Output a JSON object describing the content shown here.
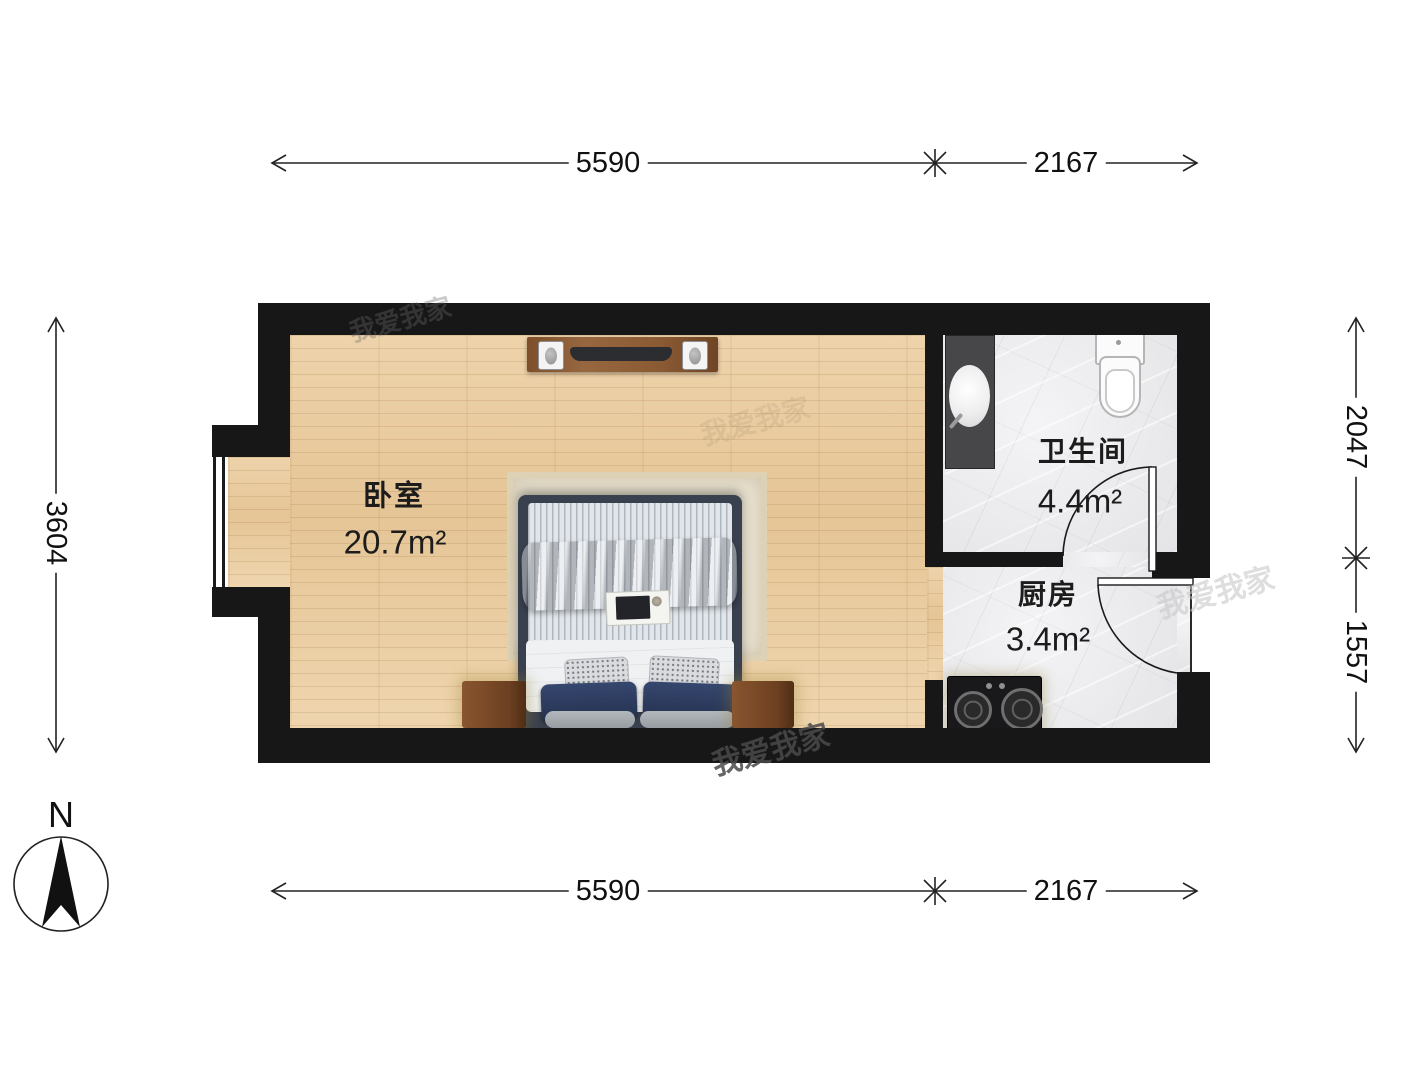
{
  "compass": {
    "label": "N"
  },
  "rooms": {
    "bedroom": {
      "name": "卧室",
      "area": "20.7m²"
    },
    "bathroom": {
      "name": "卫生间",
      "area": "4.4m²"
    },
    "kitchen": {
      "name": "厨房",
      "area": "3.4m²"
    }
  },
  "dimensions": {
    "top": {
      "left": "5590",
      "right": "2167"
    },
    "bottom": {
      "left": "5590",
      "right": "2167"
    },
    "left": {
      "value": "3604"
    },
    "right": {
      "upper": "2047",
      "lower": "1557"
    }
  },
  "watermark": {
    "text": "我爱我家"
  },
  "colors": {
    "wall": "#171717",
    "wood_floor": "#ecd1a9",
    "tile_floor": "#ededef",
    "bed_frame": "#39404e",
    "navy_pillow": "#2c3a5e",
    "nightstand": "#7c4e2d"
  }
}
